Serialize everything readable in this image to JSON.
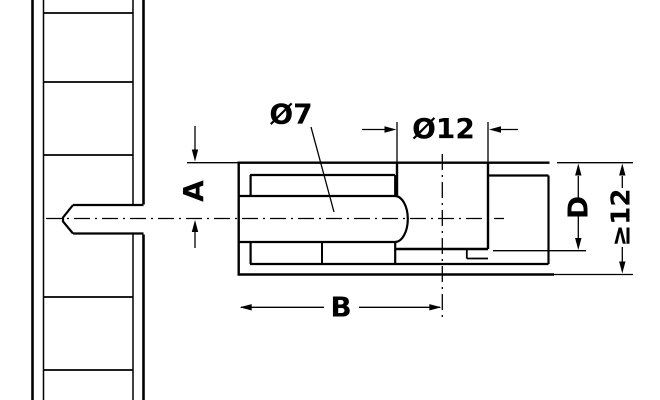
{
  "drawing": {
    "title": "connector-drilling-dimensions",
    "colors": {
      "line": "#000000",
      "background": "#ffffff"
    },
    "labels": {
      "bolt_hole_diameter": "Ø7",
      "cam_hole_diameter": "Ø12",
      "axis_distance": "A",
      "bolt_length_to_axis": "B",
      "drilling_depth": "D",
      "min_panel_thickness": "≥12"
    }
  }
}
